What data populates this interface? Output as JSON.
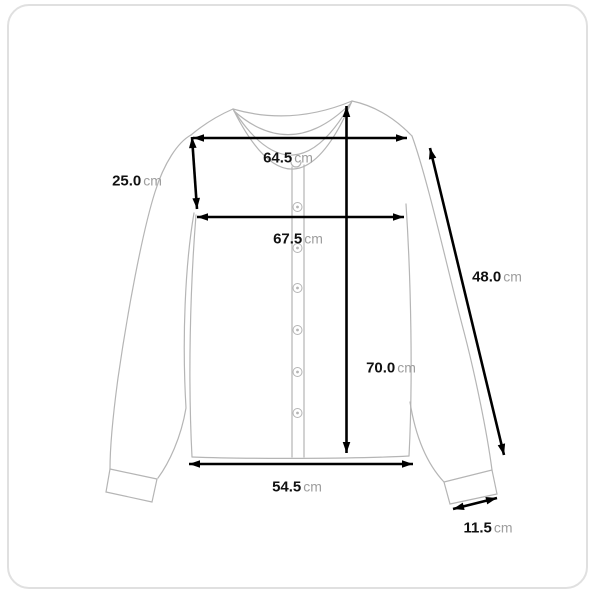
{
  "page": {
    "background": "#ffffff",
    "border_color": "#e0e0e0"
  },
  "diagram": {
    "type": "garment-size-measurement",
    "garment": "button-front cardigan, flat lay front view",
    "button_count": 6,
    "colors": {
      "garment_outline": "#b5b5b5",
      "measure_line": "#000000",
      "value_text": "#111111",
      "unit_text": "#9e9e9e"
    },
    "measurements": {
      "shoulder_width": {
        "value": "64.5",
        "unit": "cm"
      },
      "sleeve_opening": {
        "value": "25.0",
        "unit": "cm"
      },
      "chest_width": {
        "value": "67.5",
        "unit": "cm"
      },
      "sleeve_length": {
        "value": "48.0",
        "unit": "cm"
      },
      "total_length": {
        "value": "70.0",
        "unit": "cm"
      },
      "hem_width": {
        "value": "54.5",
        "unit": "cm"
      },
      "cuff_width": {
        "value": "11.5",
        "unit": "cm"
      }
    }
  }
}
